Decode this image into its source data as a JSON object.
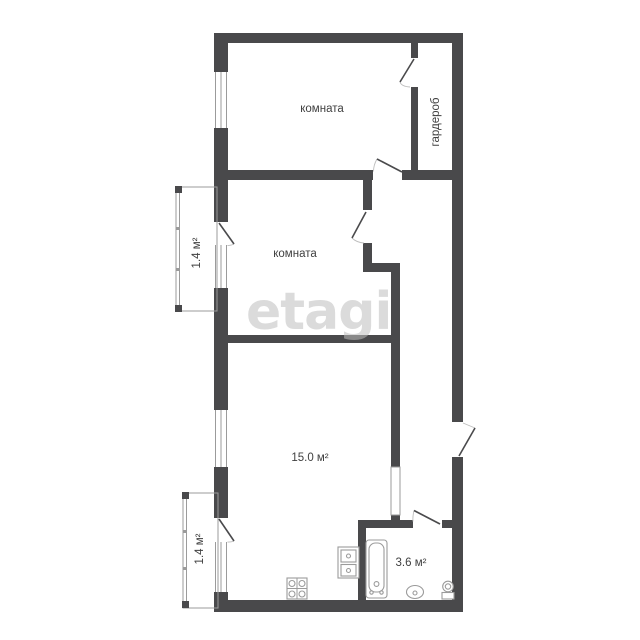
{
  "title": "floor-plan",
  "watermark": "etagi",
  "colors": {
    "wall": "#49494b",
    "thin_line": "#9b9b9b",
    "label_text": "#3f3f3f",
    "watermark": "#dbdbdb"
  },
  "rooms": [
    {
      "name": "room-top",
      "label": "комната"
    },
    {
      "name": "wardrobe",
      "label": "гардероб"
    },
    {
      "name": "room-middle",
      "label": "комната"
    },
    {
      "name": "balcony-middle",
      "label": "1.4 м²"
    },
    {
      "name": "living-kitchen",
      "label": "15.0 м²"
    },
    {
      "name": "balcony-bottom",
      "label": "1.4 м²"
    },
    {
      "name": "bathroom",
      "label": "3.6 м²"
    }
  ],
  "icons": [
    "stove-icon",
    "kitchen-sink-icon",
    "bathtub-icon",
    "washbasin-icon",
    "toilet-icon",
    "door-swing-icon",
    "window-icon"
  ]
}
